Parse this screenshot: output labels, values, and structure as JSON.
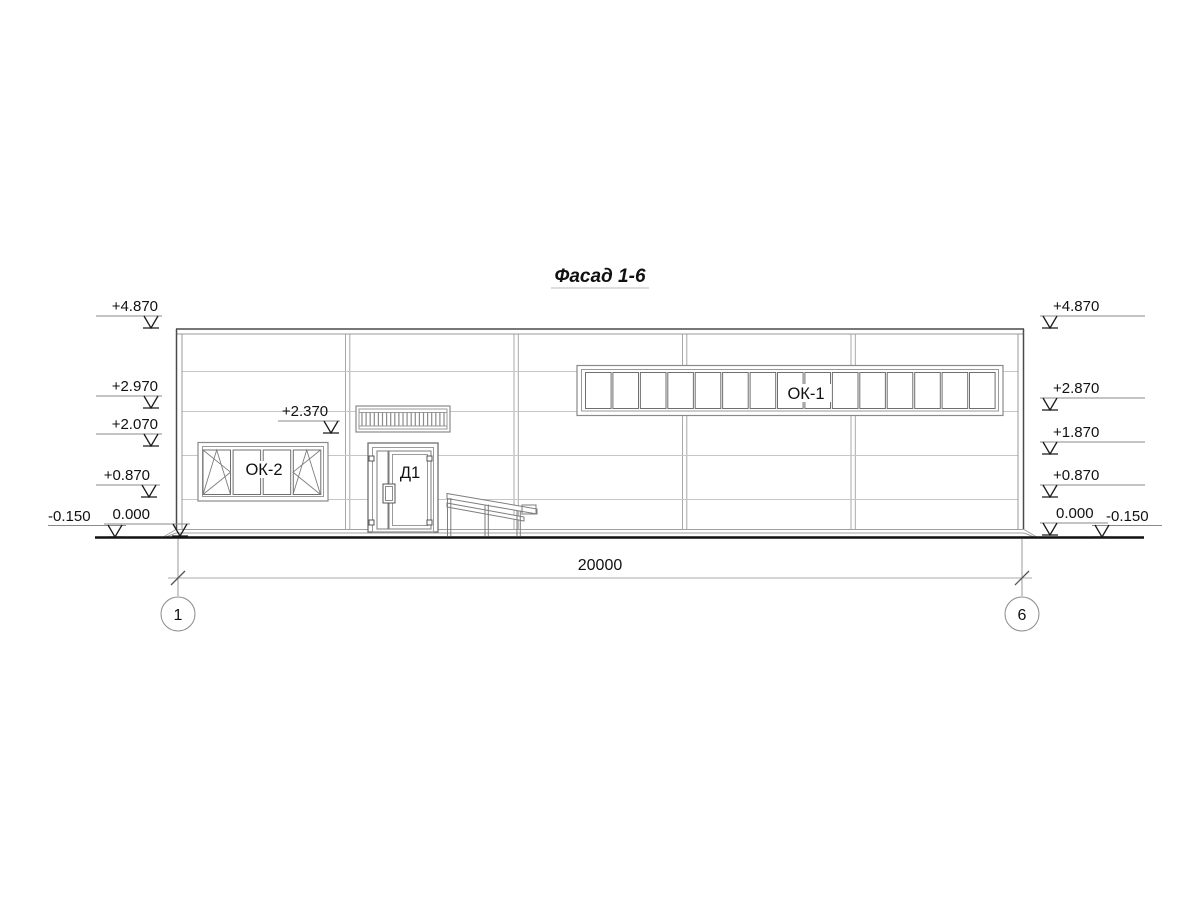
{
  "title": "Фасад 1-6",
  "facade": {
    "elevation_marks_left": [
      "+4.870",
      "+2.970",
      "+2.070",
      "+0.870",
      "0.000",
      "-0.150"
    ],
    "elevation_marks_right": [
      "+4.870",
      "+2.870",
      "+1.870",
      "+0.870",
      "0.000",
      "-0.150"
    ],
    "door_mark": "+2.370",
    "labels": {
      "ribbon_window": "ОК-1",
      "left_window": "ОК-2",
      "door": "Д1"
    },
    "windows": {
      "ok1_panes": 15,
      "ok2_panes": 4,
      "louver_slats": 21
    },
    "dimension_total": "20000",
    "axis_left": "1",
    "axis_right": "6"
  },
  "colors": {
    "background": "#ffffff",
    "line_dark": "#4a4a4a",
    "line_medium": "#8a8a8a",
    "line_light": "#c6c6c6",
    "text": "#111111",
    "ground": "#111111"
  }
}
